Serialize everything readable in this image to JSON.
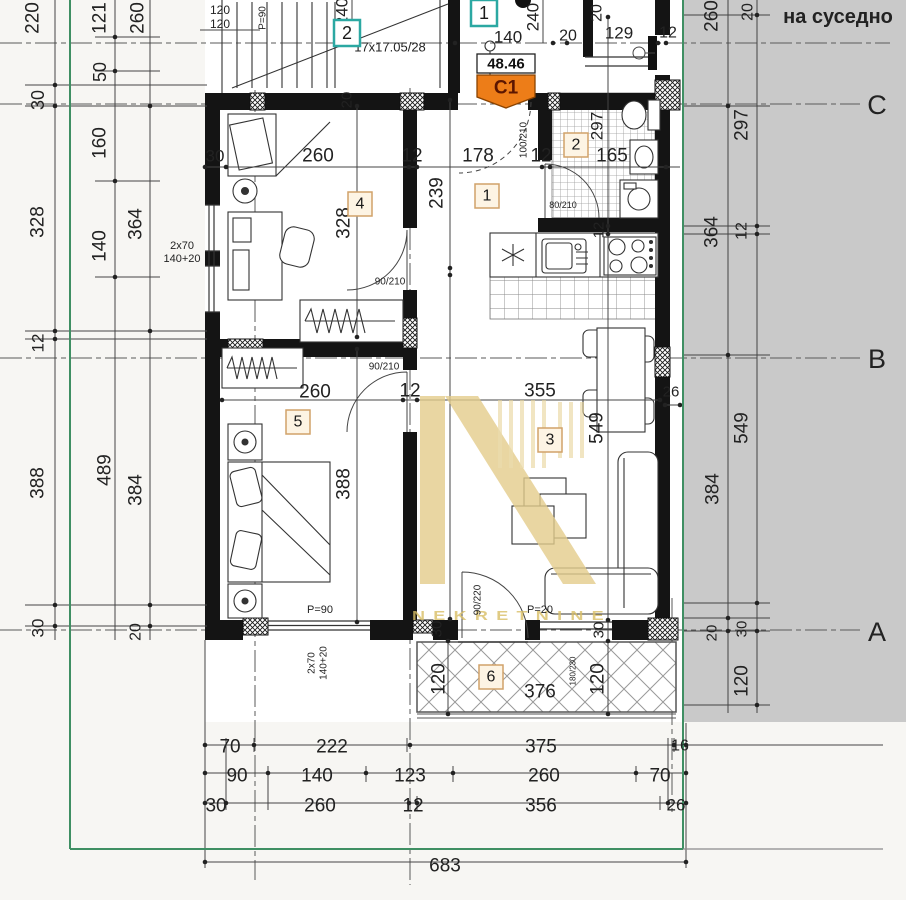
{
  "colors": {
    "accent_orange": "#ed7d18",
    "teal": "#2ba8a2",
    "boundary_green": "#3f8f63",
    "parcel_gray": "#c9c9c9",
    "watermark_gold": "#e4cd8c"
  },
  "badge": {
    "area": "48.46",
    "code": "C1"
  },
  "watermark": {
    "text": "NEKRETNINE"
  },
  "parcel": {
    "neighbor_label": "на суседно"
  },
  "entry_tags": [
    {
      "t": "2",
      "x": 347,
      "y": 33
    },
    {
      "t": "1",
      "x": 484,
      "y": 13
    }
  ],
  "room_tags": [
    {
      "t": "1",
      "x": 487,
      "y": 196
    },
    {
      "t": "2",
      "x": 576,
      "y": 145
    },
    {
      "t": "3",
      "x": 550,
      "y": 440
    },
    {
      "t": "4",
      "x": 360,
      "y": 204
    },
    {
      "t": "5",
      "x": 298,
      "y": 422
    },
    {
      "t": "6",
      "x": 491,
      "y": 677
    }
  ],
  "labels": [
    {
      "t": "220",
      "x": 33,
      "y": 18,
      "r": -90,
      "s": 19
    },
    {
      "t": "121",
      "x": 100,
      "y": 18,
      "r": -90,
      "s": 19
    },
    {
      "t": "260",
      "x": 138,
      "y": 18,
      "r": -90,
      "s": 19
    },
    {
      "t": "30",
      "x": 38,
      "y": 100,
      "r": -90,
      "s": 18
    },
    {
      "t": "50",
      "x": 100,
      "y": 72,
      "r": -90,
      "s": 18
    },
    {
      "t": "160",
      "x": 100,
      "y": 143,
      "r": -90,
      "s": 19
    },
    {
      "t": "328",
      "x": 38,
      "y": 222,
      "r": -90,
      "s": 19
    },
    {
      "t": "364",
      "x": 136,
      "y": 224,
      "r": -90,
      "s": 19
    },
    {
      "t": "140",
      "x": 100,
      "y": 246,
      "r": -90,
      "s": 19
    },
    {
      "t": "12",
      "x": 38,
      "y": 343,
      "r": -90,
      "s": 17
    },
    {
      "t": "388",
      "x": 38,
      "y": 483,
      "r": -90,
      "s": 19
    },
    {
      "t": "489",
      "x": 105,
      "y": 470,
      "r": -90,
      "s": 19
    },
    {
      "t": "384",
      "x": 136,
      "y": 490,
      "r": -90,
      "s": 19
    },
    {
      "t": "30",
      "x": 38,
      "y": 628,
      "r": -90,
      "s": 17
    },
    {
      "t": "20",
      "x": 136,
      "y": 632,
      "r": -90,
      "s": 16
    },
    {
      "t": "120",
      "x": 220,
      "y": 10,
      "s": 12
    },
    {
      "t": "120",
      "x": 220,
      "y": 24,
      "s": 12
    },
    {
      "t": "P=90",
      "x": 263,
      "y": 18,
      "r": -90,
      "s": 10
    },
    {
      "t": "240",
      "x": 342,
      "y": 12,
      "r": -90,
      "s": 17
    },
    {
      "t": "17x17.05/28",
      "x": 390,
      "y": 47,
      "s": 13
    },
    {
      "t": "140",
      "x": 508,
      "y": 37,
      "s": 17
    },
    {
      "t": "240",
      "x": 533,
      "y": 17,
      "r": -90,
      "s": 17
    },
    {
      "t": "20",
      "x": 568,
      "y": 36,
      "s": 16
    },
    {
      "t": "20",
      "x": 597,
      "y": 13,
      "r": -90,
      "s": 16
    },
    {
      "t": "129",
      "x": 619,
      "y": 33,
      "s": 17
    },
    {
      "t": "12",
      "x": 668,
      "y": 33,
      "s": 16
    },
    {
      "t": "260",
      "x": 712,
      "y": 16,
      "r": -90,
      "s": 19
    },
    {
      "t": "20",
      "x": 748,
      "y": 12,
      "r": -90,
      "s": 16
    },
    {
      "t": "на суседно",
      "x": 838,
      "y": 17,
      "s": 20,
      "f": "serif",
      "b": 1
    },
    {
      "t": "C",
      "x": 877,
      "y": 105,
      "s": 27,
      "f": "serif"
    },
    {
      "t": "B",
      "x": 877,
      "y": 359,
      "s": 27,
      "f": "serif"
    },
    {
      "t": "A",
      "x": 877,
      "y": 632,
      "s": 27,
      "f": "serif"
    },
    {
      "t": "30",
      "x": 215,
      "y": 156,
      "s": 17
    },
    {
      "t": "260",
      "x": 318,
      "y": 156,
      "s": 19
    },
    {
      "t": "12",
      "x": 412,
      "y": 156,
      "s": 19
    },
    {
      "t": "178",
      "x": 478,
      "y": 156,
      "s": 19
    },
    {
      "t": "12",
      "x": 541,
      "y": 156,
      "s": 19
    },
    {
      "t": "165",
      "x": 612,
      "y": 156,
      "s": 19
    },
    {
      "t": "297",
      "x": 597,
      "y": 126,
      "r": -90,
      "s": 17
    },
    {
      "t": "100/210",
      "x": 524,
      "y": 140,
      "r": -90,
      "s": 10
    },
    {
      "t": "80/210",
      "x": 563,
      "y": 205,
      "s": 9
    },
    {
      "t": "239",
      "x": 437,
      "y": 193,
      "r": -90,
      "s": 19
    },
    {
      "t": "20",
      "x": 347,
      "y": 100,
      "r": -90,
      "s": 15
    },
    {
      "t": "2x70",
      "x": 182,
      "y": 246,
      "s": 11
    },
    {
      "t": "140+20",
      "x": 182,
      "y": 259,
      "s": 11
    },
    {
      "t": "328",
      "x": 344,
      "y": 223,
      "r": -90,
      "s": 19
    },
    {
      "t": "90/210",
      "x": 390,
      "y": 282,
      "s": 10
    },
    {
      "t": "12",
      "x": 599,
      "y": 230,
      "r": -90,
      "s": 15
    },
    {
      "t": "260",
      "x": 315,
      "y": 392,
      "s": 19
    },
    {
      "t": "12",
      "x": 410,
      "y": 391,
      "s": 19
    },
    {
      "t": "355",
      "x": 540,
      "y": 391,
      "s": 19
    },
    {
      "t": "90/210",
      "x": 384,
      "y": 367,
      "s": 10
    },
    {
      "t": "549",
      "x": 597,
      "y": 428,
      "r": -90,
      "s": 19
    },
    {
      "t": "388",
      "x": 344,
      "y": 484,
      "r": -90,
      "s": 19
    },
    {
      "t": "26",
      "x": 671,
      "y": 392,
      "s": 15
    },
    {
      "t": "30",
      "x": 437,
      "y": 629,
      "r": -90,
      "s": 15
    },
    {
      "t": "30",
      "x": 599,
      "y": 630,
      "r": -90,
      "s": 15
    },
    {
      "t": "P=90",
      "x": 320,
      "y": 610,
      "s": 11
    },
    {
      "t": "P=20",
      "x": 540,
      "y": 610,
      "s": 11
    },
    {
      "t": "90/220",
      "x": 478,
      "y": 600,
      "r": -90,
      "s": 10
    },
    {
      "t": "2x70",
      "x": 312,
      "y": 663,
      "r": -90,
      "s": 10
    },
    {
      "t": "140+20",
      "x": 324,
      "y": 663,
      "r": -90,
      "s": 10
    },
    {
      "t": "120",
      "x": 439,
      "y": 679,
      "r": -90,
      "s": 19
    },
    {
      "t": "376",
      "x": 540,
      "y": 692,
      "s": 19
    },
    {
      "t": "120",
      "x": 598,
      "y": 679,
      "r": -90,
      "s": 19
    },
    {
      "t": "180/230",
      "x": 573,
      "y": 671,
      "r": -90,
      "s": 8
    },
    {
      "t": "297",
      "x": 742,
      "y": 125,
      "r": -90,
      "s": 19
    },
    {
      "t": "364",
      "x": 712,
      "y": 232,
      "r": -90,
      "s": 19
    },
    {
      "t": "12",
      "x": 742,
      "y": 231,
      "r": -90,
      "s": 16
    },
    {
      "t": "549",
      "x": 742,
      "y": 428,
      "r": -90,
      "s": 19
    },
    {
      "t": "384",
      "x": 713,
      "y": 489,
      "r": -90,
      "s": 19
    },
    {
      "t": "20",
      "x": 712,
      "y": 633,
      "r": -90,
      "s": 15
    },
    {
      "t": "30",
      "x": 742,
      "y": 629,
      "r": -90,
      "s": 15
    },
    {
      "t": "120",
      "x": 742,
      "y": 681,
      "r": -90,
      "s": 19
    },
    {
      "t": "70",
      "x": 230,
      "y": 747,
      "s": 19
    },
    {
      "t": "222",
      "x": 332,
      "y": 747,
      "s": 19
    },
    {
      "t": "375",
      "x": 541,
      "y": 747,
      "s": 19
    },
    {
      "t": "16",
      "x": 680,
      "y": 746,
      "s": 16
    },
    {
      "t": "90",
      "x": 237,
      "y": 776,
      "s": 19
    },
    {
      "t": "140",
      "x": 317,
      "y": 776,
      "s": 19
    },
    {
      "t": "123",
      "x": 410,
      "y": 776,
      "s": 19
    },
    {
      "t": "260",
      "x": 544,
      "y": 776,
      "s": 19
    },
    {
      "t": "70",
      "x": 660,
      "y": 776,
      "s": 19
    },
    {
      "t": "30",
      "x": 216,
      "y": 806,
      "s": 19
    },
    {
      "t": "260",
      "x": 320,
      "y": 806,
      "s": 19
    },
    {
      "t": "12",
      "x": 413,
      "y": 806,
      "s": 19
    },
    {
      "t": "356",
      "x": 541,
      "y": 806,
      "s": 19
    },
    {
      "t": "26",
      "x": 676,
      "y": 805,
      "s": 17
    },
    {
      "t": "683",
      "x": 445,
      "y": 866,
      "s": 19
    }
  ]
}
